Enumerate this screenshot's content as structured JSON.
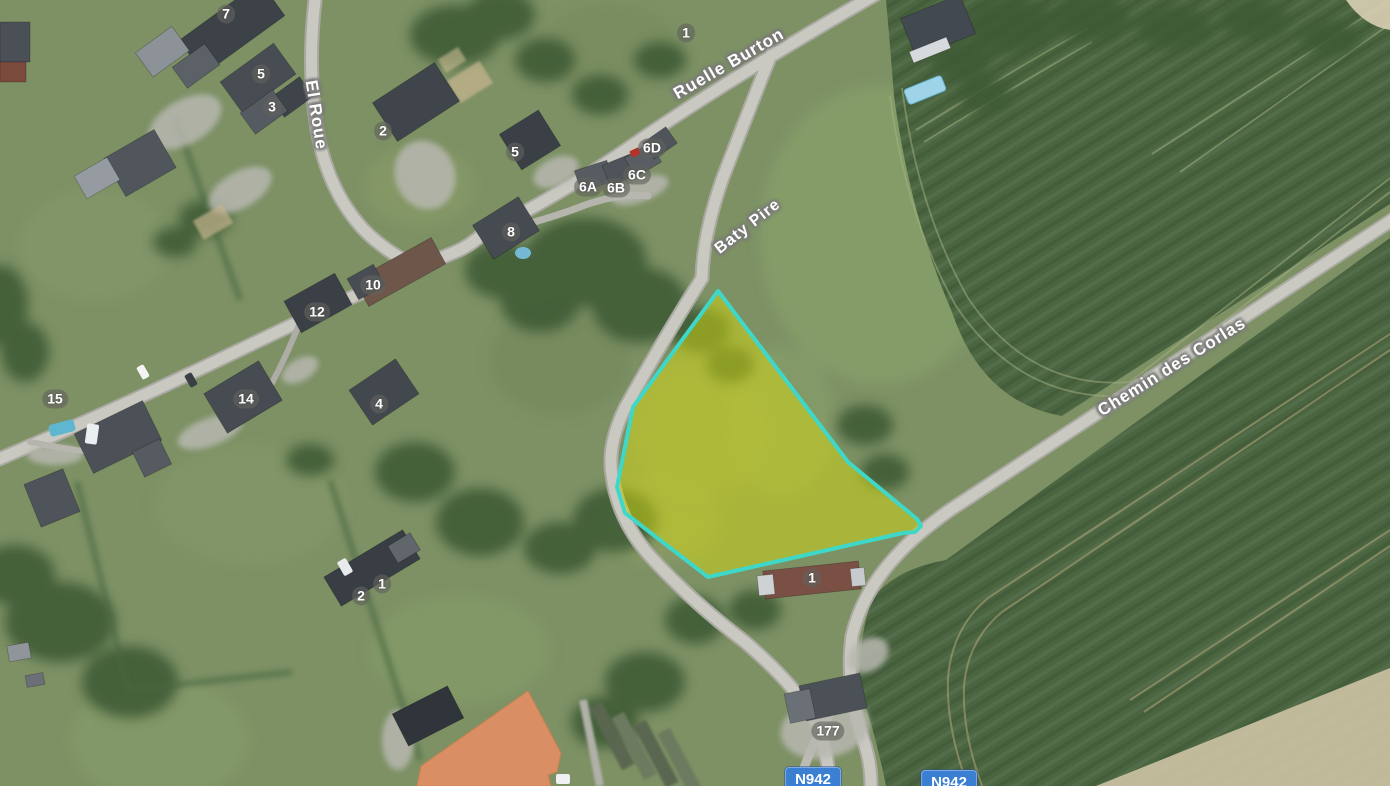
{
  "app": {
    "view": "aerial-orthophoto-map"
  },
  "colors": {
    "meadow_green": "#7d9165",
    "crop_field_dark_green": "#4a6540",
    "road_gray": "#c6c6bf",
    "parcel_highlight_fill": "rgba(214,218,16,0.5)",
    "parcel_highlight_stroke": "#3fd8c8",
    "building_footprint_orange": "#d98e63",
    "route_shield_blue": "#3b7fd2",
    "label_white": "#ffffff",
    "label_halo_gray": "#7a7a78"
  },
  "map": {
    "street_labels": [
      {
        "id": "el-roue",
        "text": "El Roue",
        "x": 316,
        "y": 115,
        "rotation": 81,
        "font_size": 17
      },
      {
        "id": "ruelle-burton",
        "text": "Ruelle Burton",
        "x": 729,
        "y": 64,
        "rotation": -30,
        "font_size": 17
      },
      {
        "id": "baty-pire",
        "text": "Baty Pire",
        "x": 748,
        "y": 227,
        "rotation": -38,
        "font_size": 16
      },
      {
        "id": "chemin-des-corlas",
        "text": "Chemin des Corlas",
        "x": 1172,
        "y": 367,
        "rotation": -32,
        "font_size": 17
      }
    ],
    "house_number_labels": [
      {
        "text": "7",
        "x": 226,
        "y": 14
      },
      {
        "text": "5",
        "x": 261,
        "y": 74
      },
      {
        "text": "3",
        "x": 272,
        "y": 107
      },
      {
        "text": "2",
        "x": 383,
        "y": 131
      },
      {
        "text": "1",
        "x": 686,
        "y": 33
      },
      {
        "text": "5",
        "x": 515,
        "y": 152
      },
      {
        "text": "6A",
        "x": 588,
        "y": 187
      },
      {
        "text": "6B",
        "x": 616,
        "y": 188
      },
      {
        "text": "6C",
        "x": 637,
        "y": 175
      },
      {
        "text": "6D",
        "x": 652,
        "y": 148
      },
      {
        "text": "8",
        "x": 511,
        "y": 232
      },
      {
        "text": "10",
        "x": 373,
        "y": 285
      },
      {
        "text": "12",
        "x": 317,
        "y": 312
      },
      {
        "text": "14",
        "x": 246,
        "y": 399
      },
      {
        "text": "15",
        "x": 55,
        "y": 399
      },
      {
        "text": "4",
        "x": 379,
        "y": 404
      },
      {
        "text": "1",
        "x": 382,
        "y": 584
      },
      {
        "text": "2",
        "x": 361,
        "y": 596
      },
      {
        "text": "1",
        "x": 812,
        "y": 578
      },
      {
        "text": "177",
        "x": 828,
        "y": 731
      }
    ],
    "route_shields": [
      {
        "text": "N942",
        "x": 813,
        "y": 767
      },
      {
        "text": "N942",
        "x": 949,
        "y": 770
      }
    ],
    "overlays": {
      "highlighted_parcel": {
        "points": "718,291 848,462 917,519 921,526 915,532 903,533 708,577 625,513 617,487 633,407",
        "fill": "rgba(214,218,16,0.5)",
        "stroke": "#3fd8c8",
        "stroke_width": 4
      },
      "building_footprint": {
        "points": "528,691 561,753 557,772 548,775 551,786 417,786 421,766",
        "fill": "#d98e63",
        "stroke": "#c9804f",
        "stroke_width": 1
      }
    }
  }
}
